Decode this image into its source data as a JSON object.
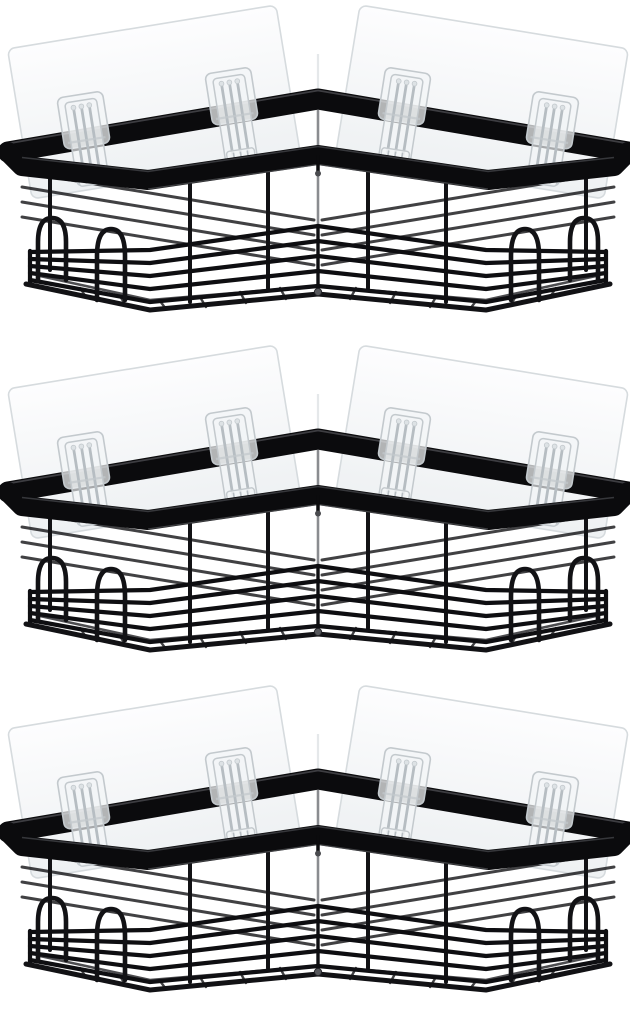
{
  "page": {
    "background": "#ffffff"
  },
  "product_photo": {
    "subject": "corner-shower-caddy-3-pack",
    "caddy_count": 3,
    "caddies": [
      {
        "id": "caddy-1"
      },
      {
        "id": "caddy-2"
      },
      {
        "id": "caddy-3"
      }
    ],
    "per_caddy": {
      "adhesive_wall_plates": 2,
      "adhesive_hooks": 4,
      "hanging_loops": 4,
      "basket_side_rails": 5
    },
    "colors": {
      "background": "#ffffff",
      "frame": "#0b0b0d",
      "wire": "#121215",
      "wire2": "#0e0e11",
      "sheen": "#46474b",
      "plate_fill_top": "#fdfdfe",
      "plate_fill_bottom": "#edf0f2",
      "plate_border": "#d6dbde",
      "hook_fill": "#f2f5f6",
      "hook_stroke": "#c3c9cd",
      "hook_ridge": "#b6bdc2"
    }
  }
}
